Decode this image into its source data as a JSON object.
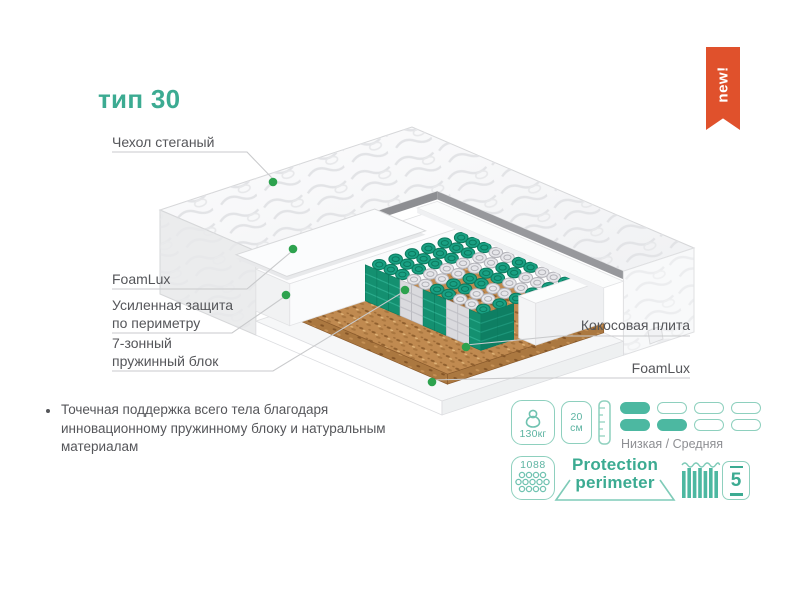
{
  "badge": {
    "label": "new!"
  },
  "title": "тип 30",
  "callouts": {
    "cover": "Чехол стеганый",
    "foamlux_left": "FoamLux",
    "perimeter_line1": "Усиленная защита",
    "perimeter_line2": "по периметру",
    "springs_line1": "7-зонный",
    "springs_line2": "пружинный блок",
    "coconut": "Кокосовая плита",
    "foamlux_right": "FoamLux"
  },
  "bullet": {
    "text": "Точечная поддержка всего тела благодаря инновационному пружинному блоку и натуральным материалам"
  },
  "features": {
    "max_weight": "130кг",
    "height_value": "20",
    "height_unit": "см",
    "firmness": {
      "label": "Низкая / Средняя",
      "rows": [
        {
          "filled": 1,
          "total": 4
        },
        {
          "filled": 2,
          "total": 4
        }
      ]
    },
    "springs_count": "1088",
    "protection_line1": "Protection",
    "protection_line2": "perimeter",
    "warranty": "5"
  },
  "colors": {
    "accent_teal": "#3cab92",
    "accent_teal_light": "#8ed0be",
    "accent_teal_mid": "#5db4a2",
    "pill_fill": "#4cb8a1",
    "badge_orange": "#e0512c",
    "text_gray": "#55565a",
    "muted_gray": "#8e8f93",
    "leader_line_gray": "#c9cacc",
    "dot_green": "#2da24e",
    "spring_teal": "#19a083",
    "spring_teal_dark": "#0c7a5e",
    "spring_teal_side": "#149070",
    "spring_gray": "#e6e6ea",
    "spring_gray_dark": "#b3b3b9",
    "spring_gray_side": "#dadade",
    "coco_brown": "#c08a50"
  }
}
